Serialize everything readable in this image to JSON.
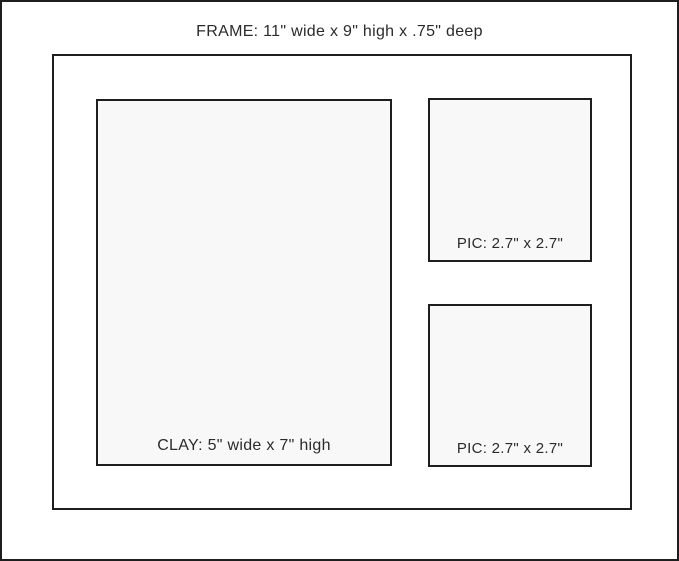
{
  "diagram": {
    "title": "FRAME: 11\" wide x 9\" high x .75\" deep",
    "openings": {
      "clay": {
        "label": "CLAY: 5\" wide x 7\" high"
      },
      "pic_top": {
        "label": "PIC: 2.7\" x 2.7\""
      },
      "pic_bottom": {
        "label": "PIC: 2.7\" x 2.7\""
      }
    },
    "colors": {
      "border": "#1e1e1e",
      "box_fill": "#f8f8f8",
      "background": "#ffffff",
      "text": "#2b2b2b"
    }
  }
}
